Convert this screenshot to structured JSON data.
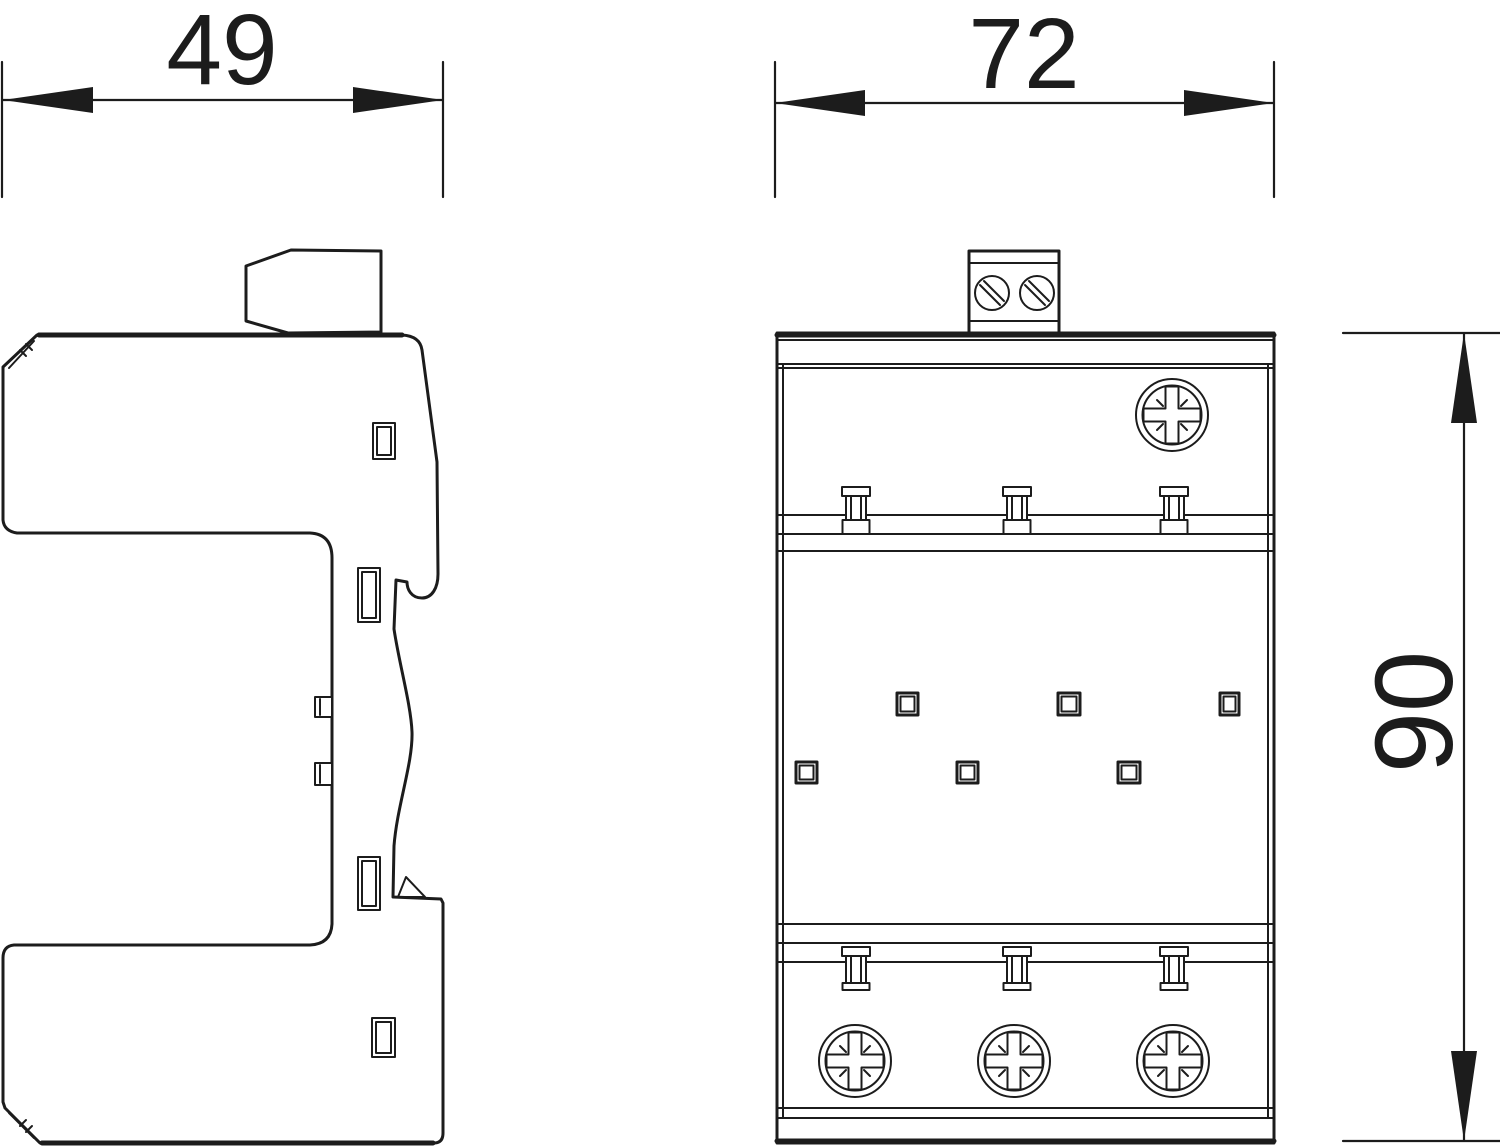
{
  "drawing": {
    "dimensions": {
      "side_width": {
        "value": "49"
      },
      "front_width": {
        "value": "72"
      },
      "front_height": {
        "value": "90"
      }
    },
    "colors": {
      "line": "#1c1c1c",
      "background": "#ffffff"
    }
  }
}
